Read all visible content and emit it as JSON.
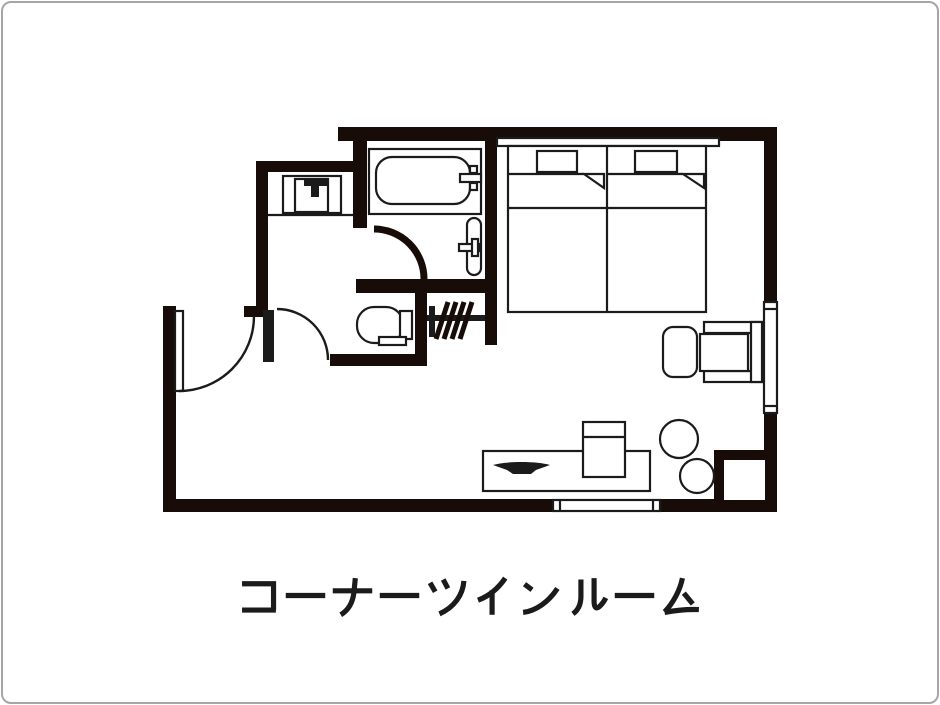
{
  "title": "コーナーツインルーム",
  "colors": {
    "wall": "#170c08",
    "line": "#1b1b1b",
    "background": "#ffffff",
    "frame": "#a6a6a6"
  },
  "plan": {
    "caption": "コーナーツインルーム",
    "rooms": [
      "bedroom",
      "unit-bath",
      "washroom",
      "toilet",
      "closet",
      "entrance"
    ],
    "fixtures": [
      "twin-bed-left",
      "twin-bed-right",
      "headboard",
      "pillow",
      "pillow",
      "bathtub",
      "bath-faucet",
      "washbasin",
      "basin-faucet",
      "vanity-counter",
      "vanity-sink",
      "vanity-faucet",
      "toilet-bowl",
      "toilet-tank",
      "hanger-rod",
      "hanger-slashes",
      "entrance-door",
      "bathroom-door",
      "toilet-door",
      "armchair",
      "ottoman",
      "round-table",
      "round-table",
      "desk",
      "tv",
      "cabinet",
      "pillar",
      "window-right",
      "window-bottom"
    ]
  }
}
